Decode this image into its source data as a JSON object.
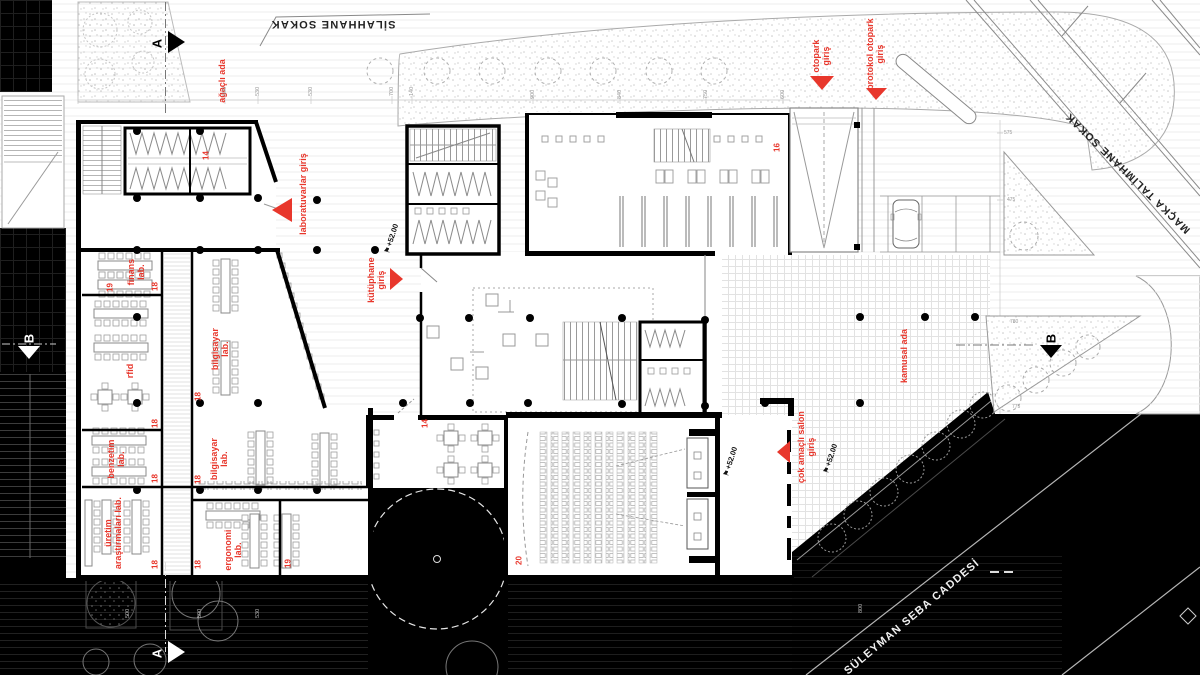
{
  "streets": {
    "top": "SİLAHHANE SOKAK",
    "right": "MAÇKA TALİMHANE SOKAK",
    "bottom": "SÜLEYMAN SEBA CADDESİ"
  },
  "areas": {
    "agacli_ada": "ağaçlı ada",
    "kamusal_ada": "kamusal ada"
  },
  "entrances": {
    "otopark": "otopark giriş",
    "protokol": "protokol otopark giriş",
    "laboratuvarlar": "laboratuvarlar giriş",
    "kutuphane": "kütüphane giriş",
    "cok_amacli": "çok amaçlı salon giriş"
  },
  "levels": {
    "kutuphane": "+52.00",
    "salon_inner": "+52.00",
    "salon_outer": "+52.00"
  },
  "rooms": {
    "finans": "finans lab.",
    "rfid": "rfid",
    "bilgisayar_ust": "bilgisayar lab.",
    "benzetim": "benzetim lab.",
    "bilgisayar_alt": "bilgisayar lab.",
    "uretim": "üretim araştırmaları lab.",
    "ergonomi": "ergonomi lab."
  },
  "numbers": {
    "wc": "14",
    "hall": "14",
    "library": "16",
    "floor": "18",
    "stair_a": "19",
    "stair_b": "19",
    "auditorium": "20"
  },
  "sections": {
    "a": "A",
    "b": "B"
  },
  "icons": {
    "level_flag": "⚑"
  },
  "dims": {
    "top": [
      "500",
      "530",
      "530",
      "700",
      "140",
      "900",
      "840",
      "750",
      "600"
    ],
    "right": [
      "575",
      "475",
      "780",
      "775"
    ],
    "bottom": [
      "500",
      "500",
      "530",
      "800"
    ]
  },
  "colors": {
    "accent_red": "#e8372c",
    "ink": "#000000",
    "paper": "#ffffff"
  }
}
